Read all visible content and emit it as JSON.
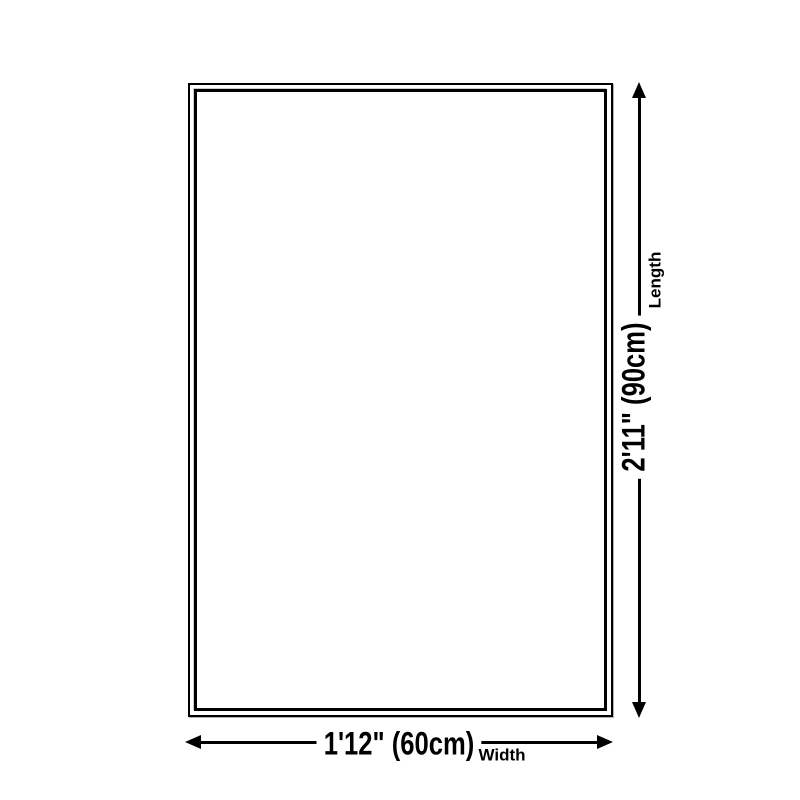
{
  "diagram": {
    "background_color": "#ffffff",
    "line_color": "#000000",
    "text_color": "#000000",
    "rug_outline": {
      "outer_border_px": 2,
      "inner_border_px": 3
    },
    "length_dimension": {
      "value": "2'11\" (90cm)",
      "label": "Length",
      "arrow_icons": [
        "arrow-up-icon",
        "arrow-down-icon"
      ]
    },
    "width_dimension": {
      "value": "1'12\" (60cm)",
      "label": "Width",
      "arrow_icons": [
        "arrow-left-icon",
        "arrow-right-icon"
      ]
    }
  }
}
